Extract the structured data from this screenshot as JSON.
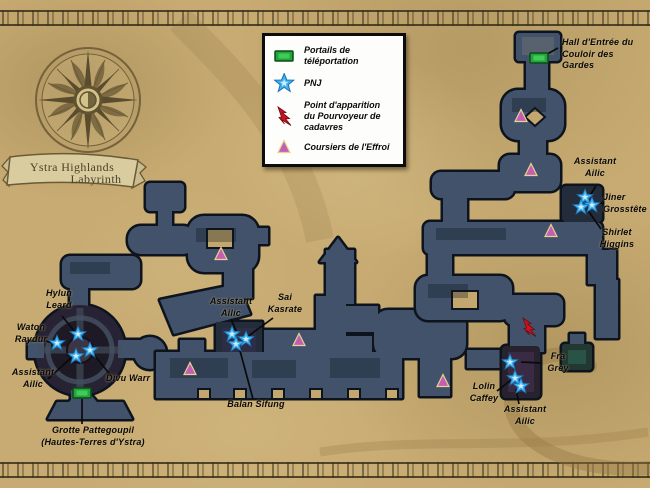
{
  "title_banner": {
    "line1": "Ystra Highlands",
    "line2": "Labyrinth"
  },
  "legend": {
    "items": [
      {
        "icon": "portal-icon",
        "label": "Portails de\ntéléportation"
      },
      {
        "icon": "npc-star-icon",
        "label": "PNJ"
      },
      {
        "icon": "spawn-lightning-icon",
        "label": "Point d'apparition\ndu Pourvoyeur de\ncadavres"
      },
      {
        "icon": "courier-triangle-icon",
        "label": "Coursiers de l'Effroi"
      }
    ]
  },
  "colors": {
    "portal": "#24a53c",
    "npc": "#3fb0ef",
    "spawn": "#c8151f",
    "courier": "#c25fb5",
    "labyrinth": "#41526a",
    "parchment": "#c7ab72"
  },
  "map": {
    "labels": {
      "hall": "Hall d'Entrée du\nCouloir des Gardes",
      "assistant_ailic_ne": "Assistant\nAilic",
      "jiner": "Jiner\nGrosstête",
      "shirlet": "Shirlet\nHiggins",
      "hylun": "Hylun\nLeard",
      "waton": "Waton\nRaydur",
      "assistant_ailic_w": "Assistant\nAilic",
      "divu": "Divu Warr",
      "grotte": "Grotte Pattegoupil\n(Hautes-Terres d'Ystra)",
      "assistant_ailic_c": "Assistant\nAilic",
      "sai": "Sai\nKasrate",
      "balan": "Balan Sifung",
      "fra": "Fra\nGrey",
      "lolin": "Lolin\nCaffey",
      "assistant_ailic_s": "Assistant\nAilic"
    },
    "markers": {
      "portals": [
        {
          "x": 539,
          "y": 58
        },
        {
          "x": 82,
          "y": 393
        }
      ],
      "npcs": [
        {
          "x": 57,
          "y": 343
        },
        {
          "x": 78,
          "y": 334
        },
        {
          "x": 90,
          "y": 350
        },
        {
          "x": 76,
          "y": 356
        },
        {
          "x": 232,
          "y": 334
        },
        {
          "x": 246,
          "y": 339
        },
        {
          "x": 236,
          "y": 344
        },
        {
          "x": 585,
          "y": 197
        },
        {
          "x": 592,
          "y": 205
        },
        {
          "x": 581,
          "y": 207
        },
        {
          "x": 510,
          "y": 362
        },
        {
          "x": 515,
          "y": 378
        },
        {
          "x": 521,
          "y": 386
        }
      ],
      "spawn_points": [
        {
          "x": 529,
          "y": 327
        }
      ],
      "couriers": [
        {
          "x": 521,
          "y": 116
        },
        {
          "x": 531,
          "y": 170
        },
        {
          "x": 551,
          "y": 231
        },
        {
          "x": 221,
          "y": 254
        },
        {
          "x": 190,
          "y": 369
        },
        {
          "x": 299,
          "y": 340
        },
        {
          "x": 443,
          "y": 381
        }
      ]
    }
  }
}
